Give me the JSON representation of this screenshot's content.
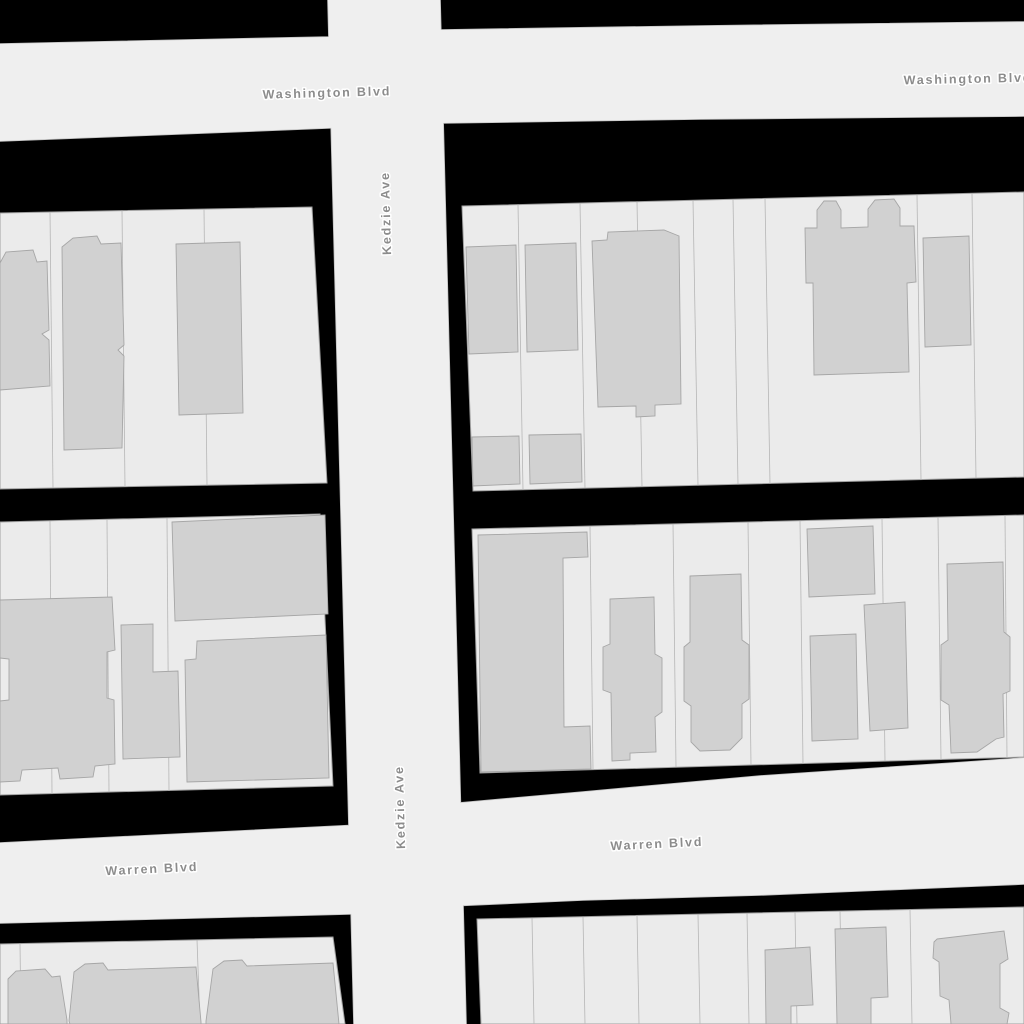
{
  "map": {
    "type": "street-map-tile",
    "streets": {
      "washington": "Washington Blvd",
      "kedzie": "Kedzie Ave",
      "warren": "Warren Blvd"
    },
    "labels": [
      {
        "id": "washington-west",
        "street": "Washington Blvd",
        "orientation": "horizontal"
      },
      {
        "id": "washington-east",
        "street": "Washington Blvd",
        "orientation": "horizontal",
        "clipped": "right-edge"
      },
      {
        "id": "kedzie-north",
        "street": "Kedzie Ave",
        "orientation": "vertical"
      },
      {
        "id": "kedzie-south",
        "street": "Kedzie Ave",
        "orientation": "vertical"
      },
      {
        "id": "warren-west",
        "street": "Warren Blvd",
        "orientation": "horizontal"
      },
      {
        "id": "warren-east",
        "street": "Warren Blvd",
        "orientation": "horizontal"
      }
    ],
    "colors": {
      "background": "#000000",
      "road_fill": "#efefef",
      "road_casing": "#c2c2c2",
      "parcel_fill": "#ebebeb",
      "parcel_line": "#b6b6b6",
      "block_outline": "#a0a0a0",
      "building_fill": "#d1d1d1",
      "building_outline": "#a6a6a6",
      "label_color": "#8c8c8c",
      "label_halo": "#ffffff"
    }
  }
}
